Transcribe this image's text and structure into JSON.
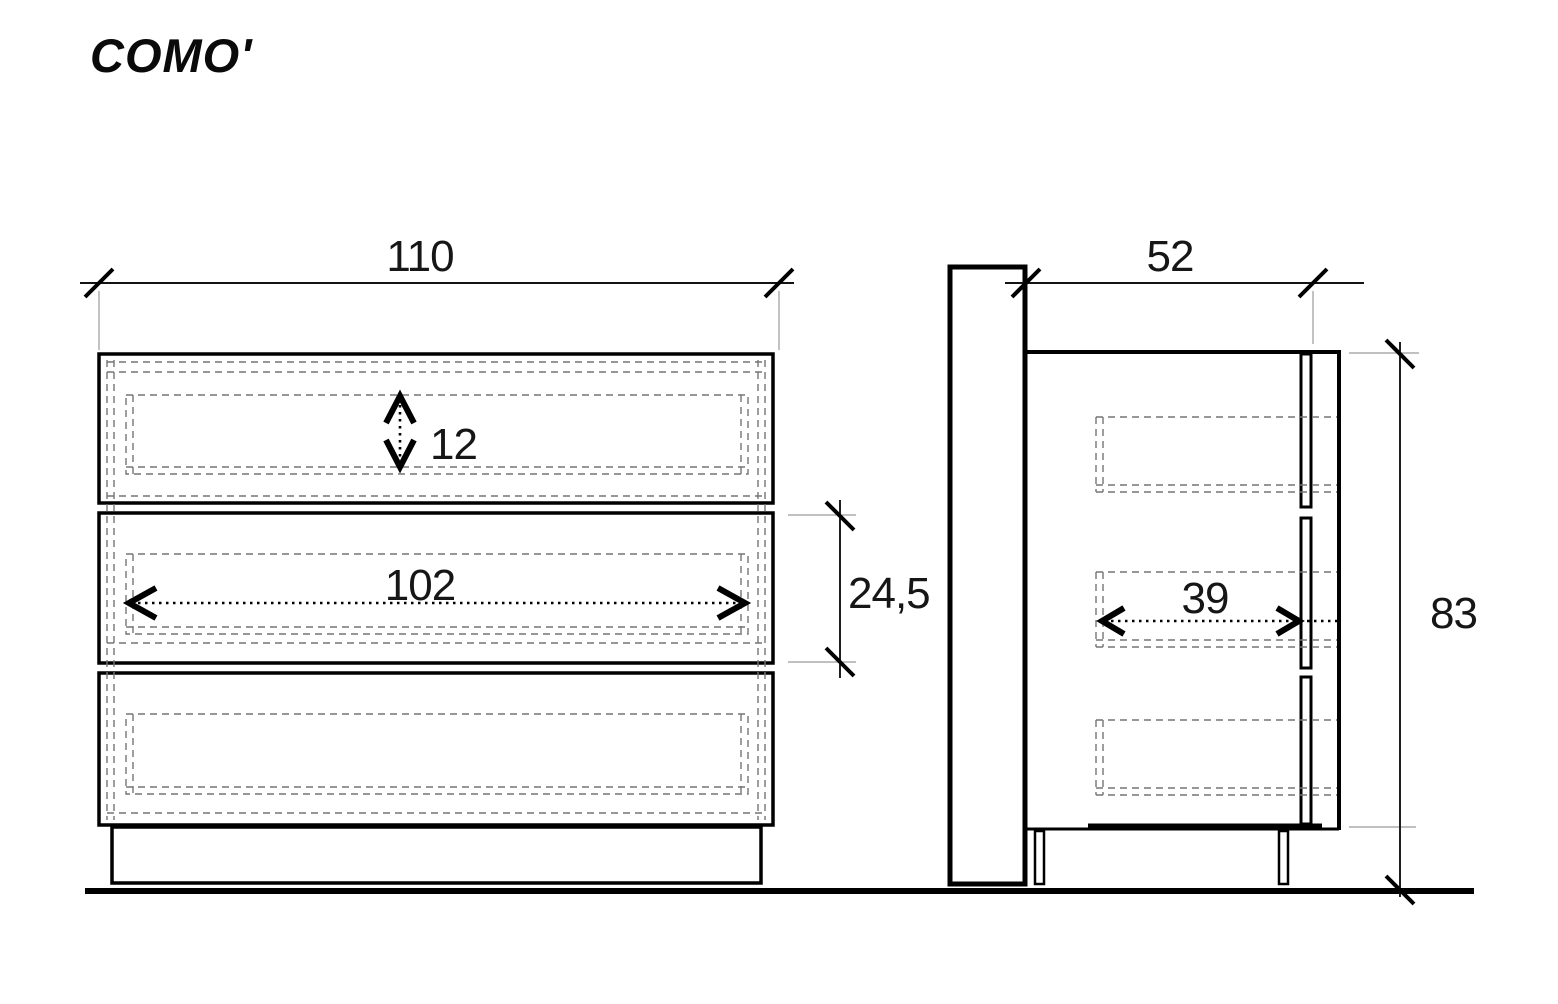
{
  "title": "COMO'",
  "dimensions": {
    "front_width": "110",
    "drawer_inner_height": "12",
    "drawer_inner_width": "102",
    "drawer_front_height": "24,5",
    "side_depth": "52",
    "drawer_inner_depth": "39",
    "total_height": "83"
  },
  "colors": {
    "line": "#000000",
    "dashed_hidden_line": "#757575",
    "extension_line": "#9a9a9a",
    "background": "#ffffff"
  }
}
